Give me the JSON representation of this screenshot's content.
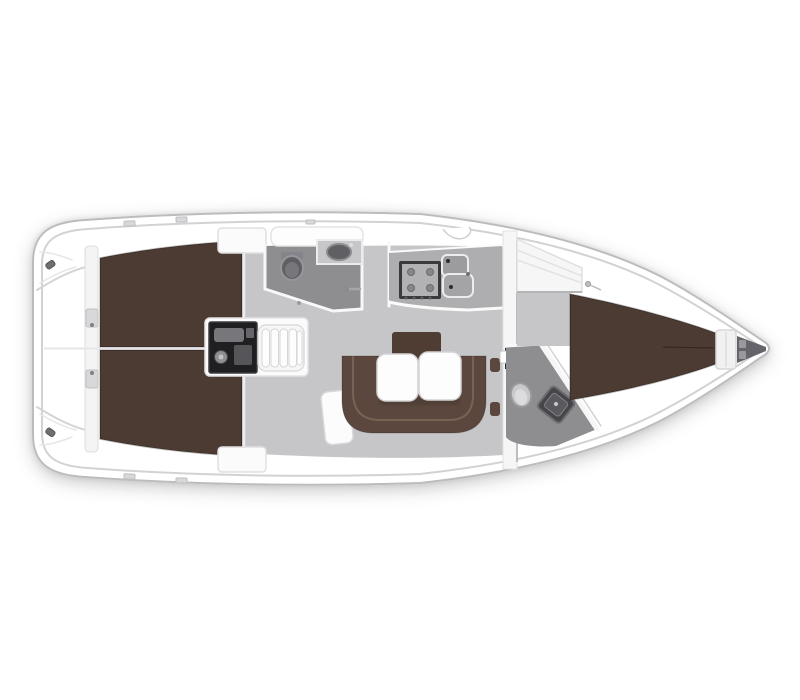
{
  "figure": {
    "type": "yacht-interior-deck-plan",
    "orientation": "bow-right",
    "background": "#ffffff"
  },
  "palette": {
    "hull_fill": "#ffffff",
    "hull_outline": "#bcbcbe",
    "inner_deck_line": "#d2d2d4",
    "floor": "#c6c6c8",
    "head_floor": "#8e8e90",
    "counter": "#aeaeb0",
    "berth_brown": "#4c3b32",
    "settee_brown": "#5b473d",
    "backrest_brown": "#4f3d34",
    "table_white": "#fdfdfe",
    "wall_white": "#f6f6f7",
    "engine_dark": "#1f1f21",
    "steps_white": "#f6f6f7",
    "fixture_dark": "#606064",
    "fixture_light": "#c9c9cb",
    "anchor_locker": "#64646a",
    "stove_frame": "#3a3a3c",
    "stove_panel": "#b2b2b4",
    "sink_gray": "#9c9c9e",
    "transom_wall": "#f4f4f5",
    "locker_white": "#f6f6f7"
  },
  "rooms": [
    "stern-platform",
    "aft-cabin-port",
    "aft-cabin-starboard",
    "engine-compartment",
    "companionway",
    "aft-head",
    "galley",
    "saloon",
    "forward-head",
    "forward-cabin",
    "anchor-locker"
  ],
  "fixtures": [
    "double-berth-aft-port",
    "double-berth-aft-starboard",
    "engine",
    "companionway-steps",
    "toilet-aft",
    "washbasin-aft",
    "shower-handle",
    "stove",
    "double-sink",
    "u-settee",
    "settee-backrest",
    "folding-table",
    "chart-seat",
    "bulkhead-door",
    "toilet-forward",
    "washbasin-forward",
    "hanging-locker",
    "v-berth",
    "anchor-locker-bin"
  ]
}
